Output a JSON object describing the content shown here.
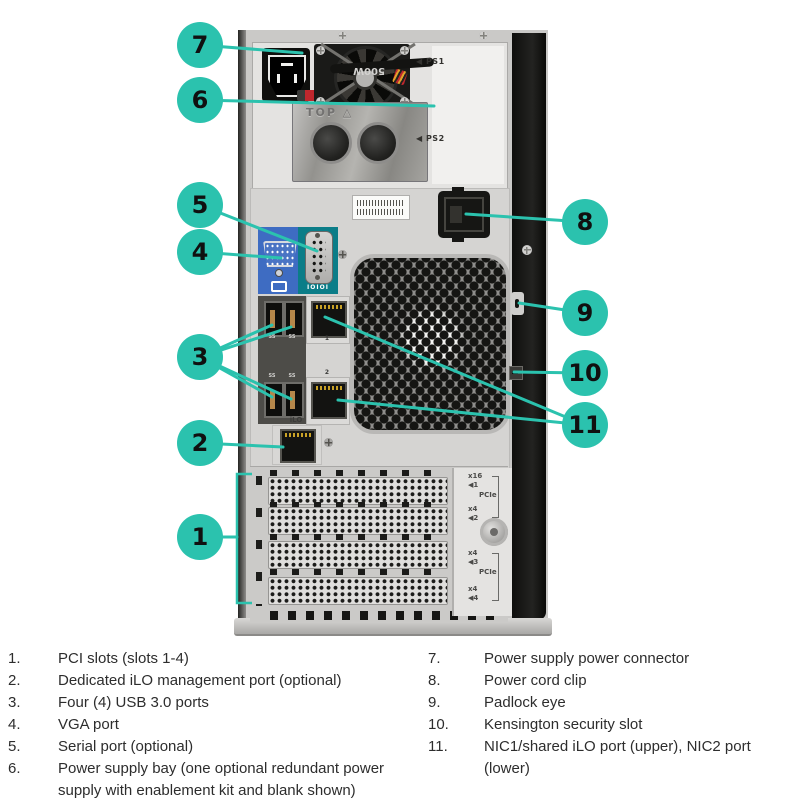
{
  "figure": {
    "title": "Tower server rear view diagram",
    "accent_color": "#2bc2ae"
  },
  "callouts": [
    {
      "number": "1"
    },
    {
      "number": "2"
    },
    {
      "number": "3"
    },
    {
      "number": "4"
    },
    {
      "number": "5"
    },
    {
      "number": "6"
    },
    {
      "number": "7"
    },
    {
      "number": "8"
    },
    {
      "number": "9"
    },
    {
      "number": "10"
    },
    {
      "number": "11"
    }
  ],
  "panel_labels": {
    "ps1": "◀ PS1",
    "ps2": "◀ PS2",
    "psu_wattage": "500W",
    "blank_top": "TOP △",
    "serial": "IOIOI",
    "usb": "SS",
    "nic1": "1",
    "nic2": "2",
    "ilo": "iLO",
    "pcie_slot1": "x16",
    "pcie_arrow1": "◀1",
    "pcie_group1": "PCIe",
    "pcie_slot2": "x4",
    "pcie_arrow2": "◀2",
    "pcie_slot3": "x4",
    "pcie_arrow3": "◀3",
    "pcie_group2": "PCIe",
    "pcie_slot4": "x4",
    "pcie_arrow4": "◀4"
  },
  "legend": {
    "left": [
      {
        "num": "1.",
        "text": "PCI slots (slots 1-4)"
      },
      {
        "num": "2.",
        "text": "Dedicated iLO management port (optional)"
      },
      {
        "num": "3.",
        "text": "Four (4) USB 3.0 ports"
      },
      {
        "num": "4.",
        "text": "VGA port"
      },
      {
        "num": "5.",
        "text": "Serial port (optional)"
      },
      {
        "num": "6.",
        "text": "Power supply bay (one optional redundant power supply with enablement kit and blank shown)"
      }
    ],
    "right": [
      {
        "num": "7.",
        "text": "Power supply power connector"
      },
      {
        "num": "8.",
        "text": "Power cord clip"
      },
      {
        "num": "9.",
        "text": "Padlock eye"
      },
      {
        "num": "10.",
        "text": "Kensington security slot"
      },
      {
        "num": "11.",
        "text": "NIC1/shared iLO port (upper), NIC2 port (lower)"
      }
    ]
  }
}
